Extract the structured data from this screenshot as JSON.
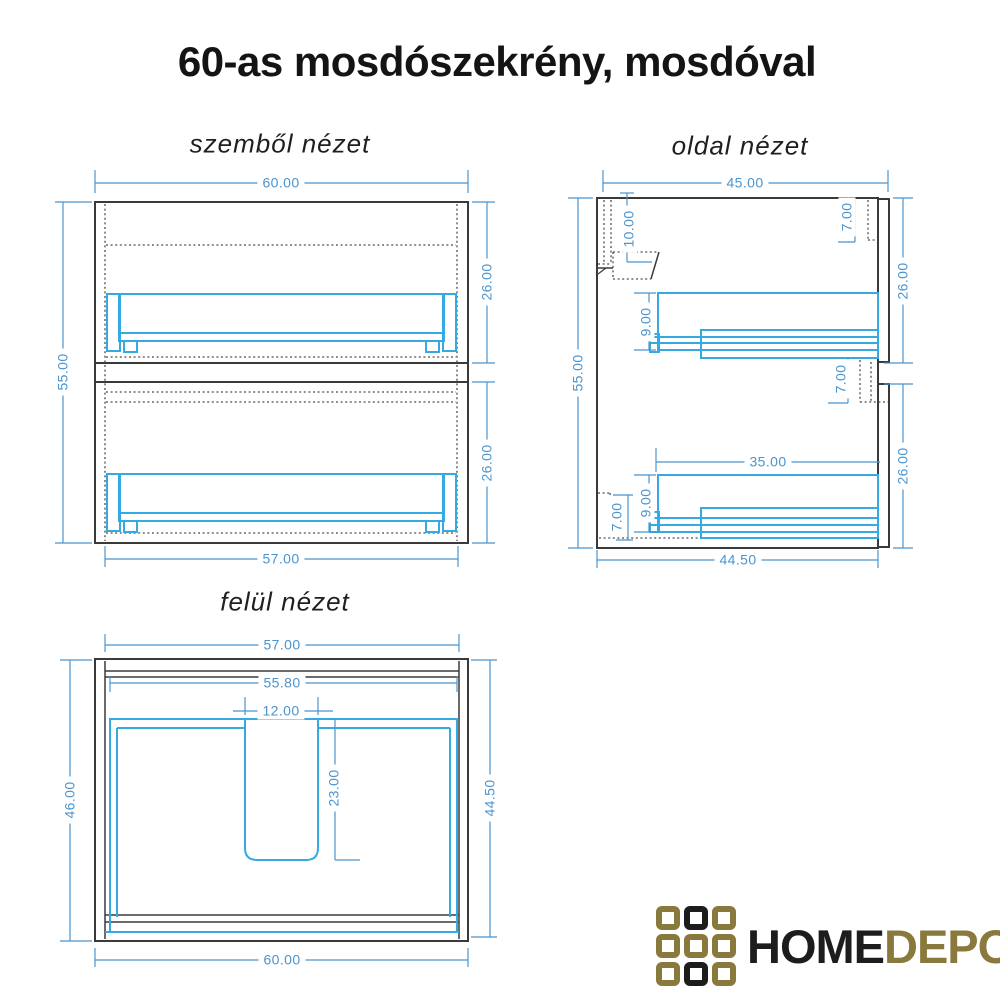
{
  "title": "60-as mosdószekrény, mosdóval",
  "views": {
    "front": {
      "label": "szemből nézet",
      "dims": {
        "width_top": "60.00",
        "height_left": "55.00",
        "upper_section_height": "26.00",
        "lower_section_height": "26.00",
        "width_bottom": "57.00"
      }
    },
    "side": {
      "label": "oldal nézet",
      "dims": {
        "depth_top": "45.00",
        "height_left": "55.00",
        "hanger_offset": "10.00",
        "top_recess": "7.00",
        "upper_section_height": "26.00",
        "mid_gap": "7.00",
        "drawer_depth": "35.00",
        "upper_drawer_height": "9.00",
        "lower_drawer_height": "9.00",
        "plinth_height": "7.00",
        "lower_section_height": "26.00",
        "depth_bottom": "44.50"
      }
    },
    "top": {
      "label": "felül nézet",
      "dims": {
        "width_top": "57.00",
        "inner_width": "55.80",
        "cutout_width": "12.00",
        "cutout_depth": "23.00",
        "depth_left": "46.00",
        "depth_right": "44.50",
        "width_bottom": "60.00"
      }
    }
  },
  "logo": {
    "home": "HOME",
    "depo": "DEPO",
    "grid_cells": [
      "gold",
      "black",
      "gold",
      "gold",
      "gold",
      "gold",
      "gold",
      "black",
      "gold"
    ]
  },
  "colors": {
    "dimension_blue": "#4a94cf",
    "drawer_cyan": "#35a9e1",
    "line_dark": "#3a3a3a",
    "hidden_gray": "#4d4d4d",
    "logo_gold": "#8a793c",
    "logo_black": "#1d1d1d"
  }
}
